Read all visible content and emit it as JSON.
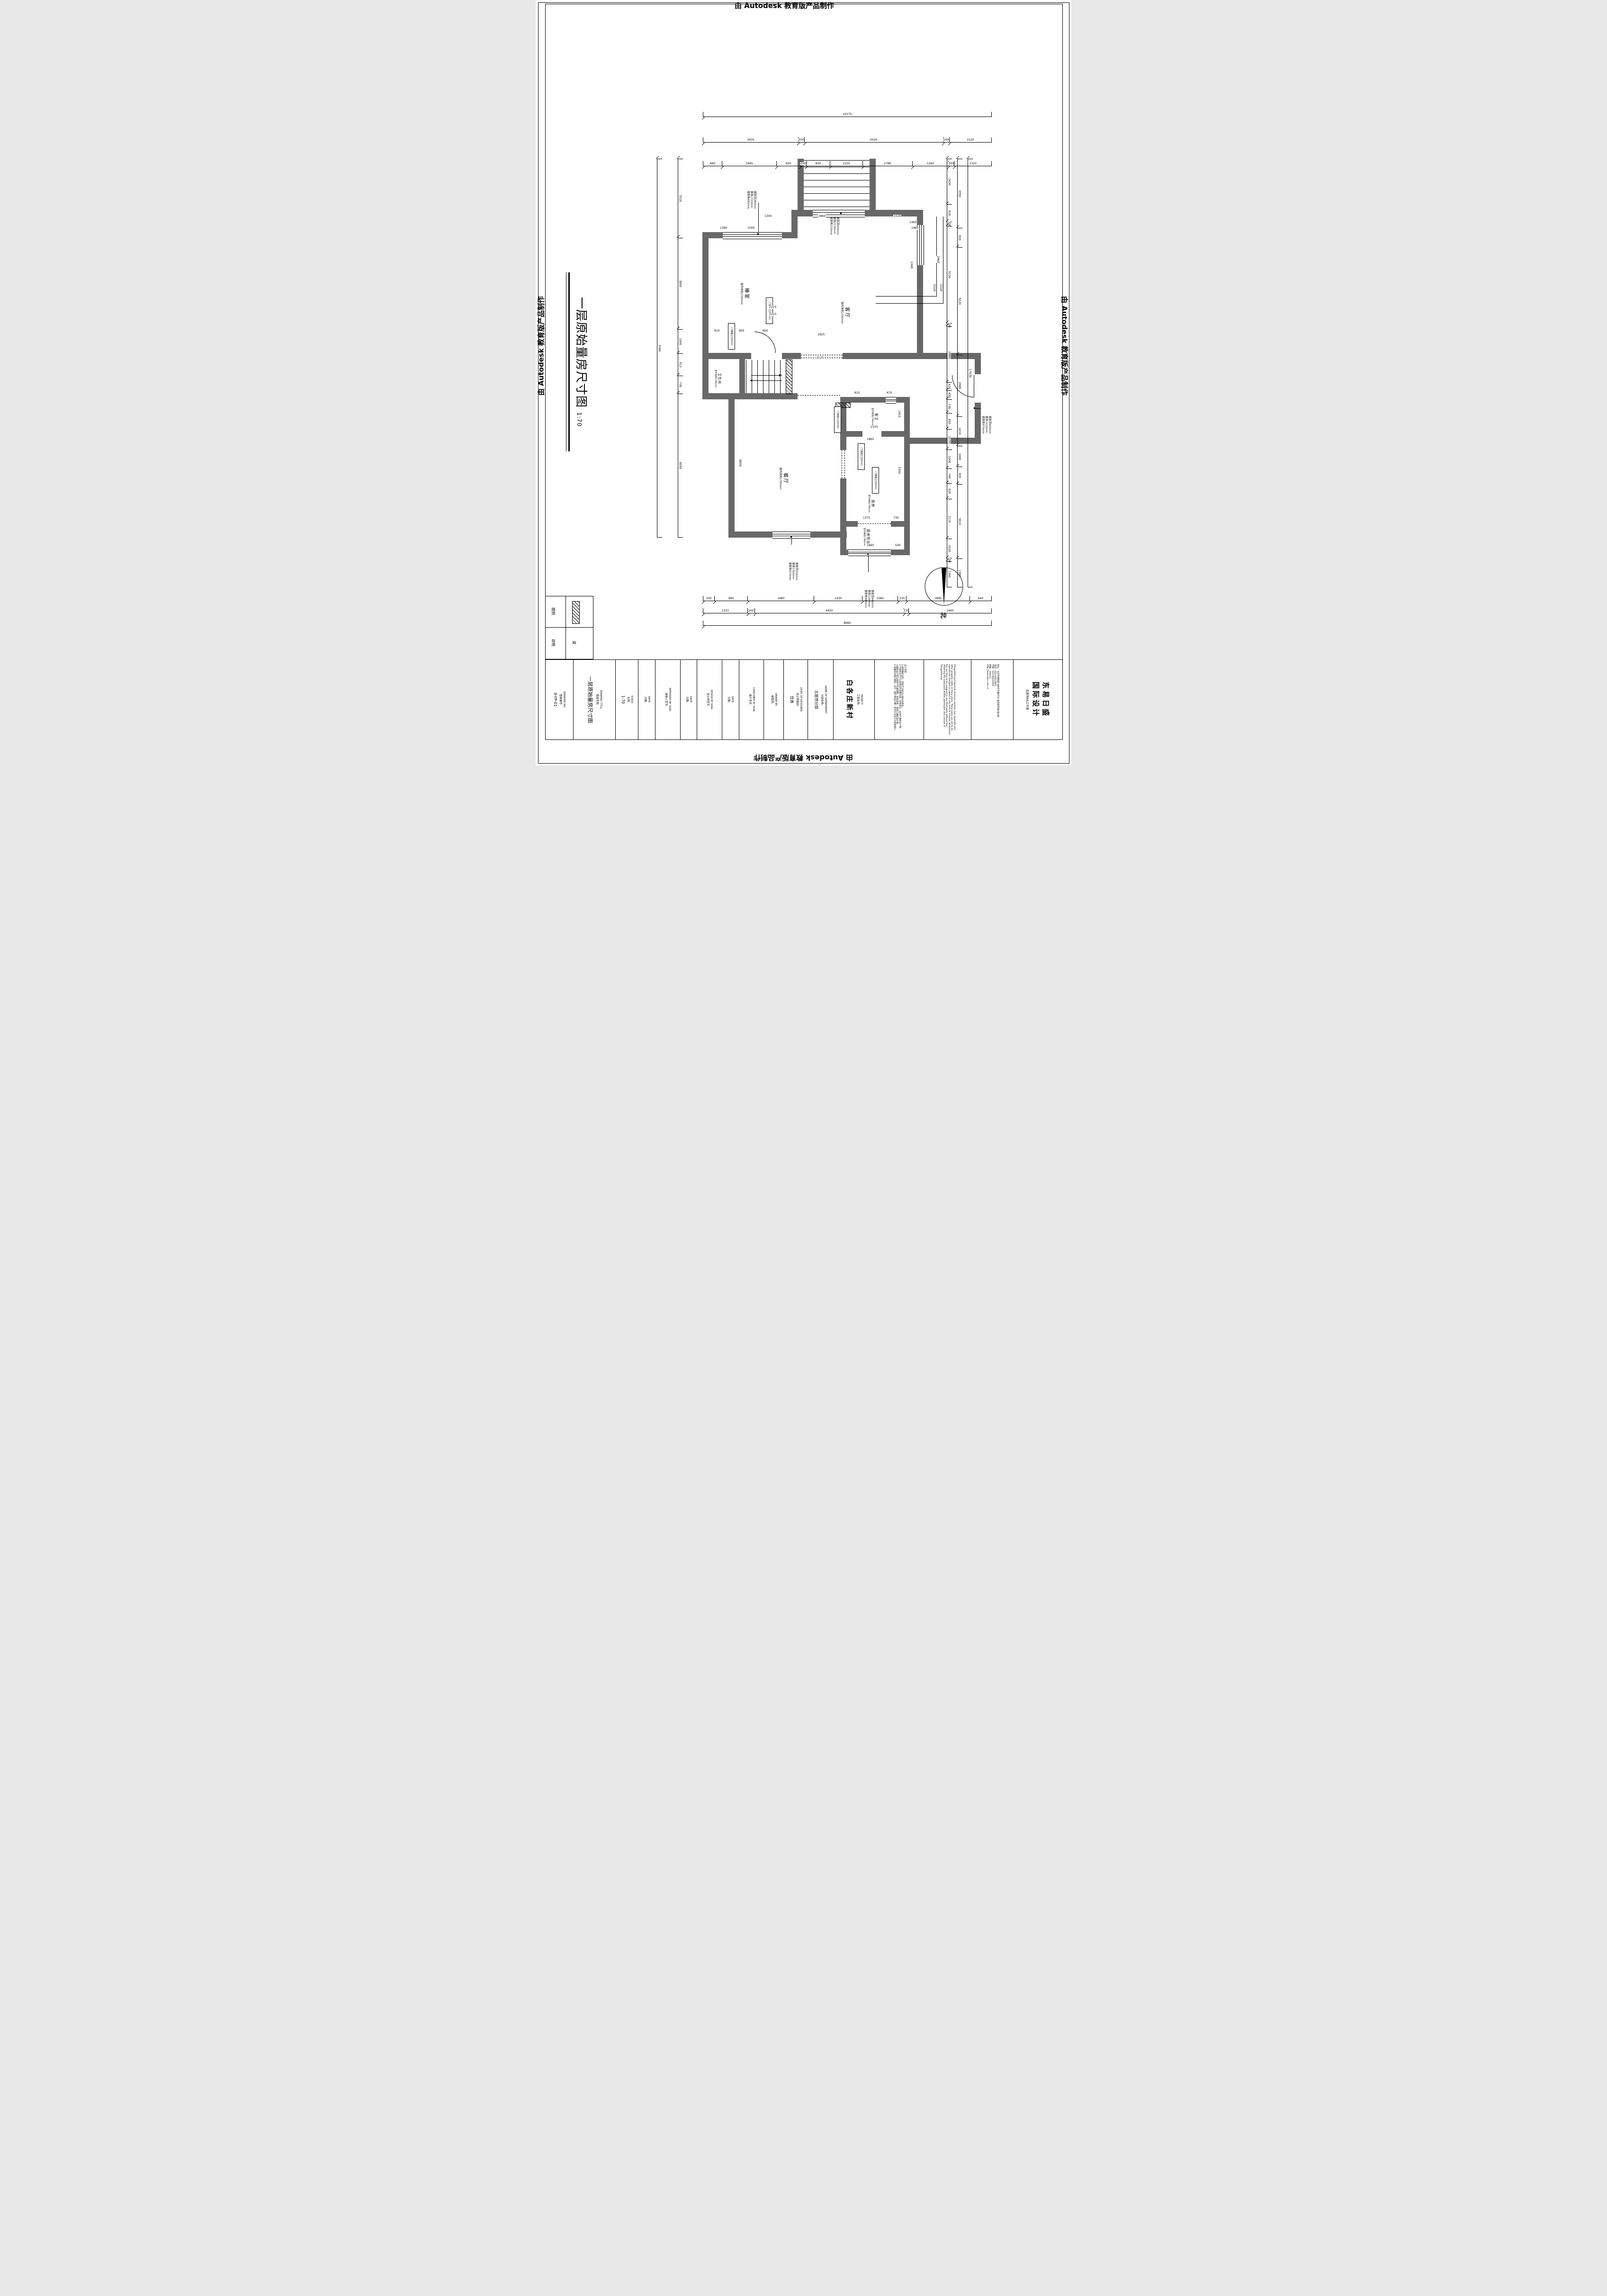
{
  "watermarks": {
    "top": "由 Autodesk 教育版产品制作",
    "right": "由 Autodesk 教育版产品制作",
    "bottom": "由 Autodesk 教育版产品制作",
    "left": "由 Autodesk 教育版产品制作"
  },
  "sheet": {
    "title": "一层原始量房尺寸图",
    "scale_note": "1:70"
  },
  "north": {
    "label": "北"
  },
  "rooms": {
    "bedroom": {
      "name": "睡室",
      "height": "室内净高2780mm"
    },
    "living": {
      "name": "客厅",
      "height": "室内净高2780mm"
    },
    "bath": {
      "name": "卫生间",
      "height": "室内净高2780mm"
    },
    "guest_bath": {
      "name": "客卫",
      "height": "室内净高2780mm"
    },
    "dining": {
      "name": "餐厅",
      "height": "室内净高2780mm"
    },
    "kitchen": {
      "name": "厨房",
      "height": "室内净高2780mm"
    },
    "balcony": {
      "name": "厨房阳台",
      "height": "室内净高2780mm"
    }
  },
  "door_note": "门洞高2150mm",
  "window_notes": {
    "bedroom": [
      "窗距顶380mm",
      "窗高1720mm",
      "窗距地680mm"
    ],
    "entry": [
      "窗距顶400mm",
      "窗高2230mm",
      "窗距地150mm"
    ],
    "vestibule": [
      "窗距顶400mm",
      "窗高1410mm",
      "窗距地970mm"
    ],
    "dining": [
      "窗距顶330mm",
      "窗高1760mm",
      "窗距地970mm"
    ],
    "balcony": [
      "窗距顶460mm",
      "窗高1340mm",
      "窗距地980mm"
    ]
  },
  "dims": {
    "top": {
      "total": [
        "10175"
      ],
      "mid": [
        "3435",
        "200",
        "5020",
        "200",
        "1520"
      ],
      "detail": [
        "660",
        "1945",
        "830",
        "200",
        "830",
        "1150",
        "1780",
        "1260",
        "200",
        "1320"
      ]
    },
    "left": {
      "total": [
        "7060"
      ],
      "detail": [
        "3320",
        "3850",
        "1000",
        "913",
        "730",
        "6050"
      ]
    },
    "right": {
      "total": [
        "17630"
      ],
      "mid": [
        "3350",
        "920",
        "5220",
        "2980",
        "1410",
        "1000",
        "820",
        "3610",
        "1360"
      ],
      "detail": [
        "2430",
        "920",
        "200",
        "5220",
        "150",
        "2980",
        "410",
        "450",
        "730",
        "850",
        "1070",
        "1000",
        "760",
        "820",
        "2110",
        "1020",
        "150",
        "1360"
      ]
    },
    "bottom": {
      "total": [
        "8660"
      ],
      "mid": [
        "1315",
        "200",
        "4450",
        "130",
        "2465"
      ],
      "detail": [
        "330",
        "985",
        "1980",
        "1430",
        "1060",
        "235",
        "1895",
        "640"
      ]
    },
    "plan": [
      "1300",
      "2860",
      "1530",
      "1380",
      "1000",
      "1460",
      "2210",
      "2210",
      "610",
      "900",
      "600",
      "1925",
      "2125",
      "5220",
      "5220",
      "2330",
      "1960",
      "810",
      "670",
      "1410",
      "3350",
      "8650",
      "1375",
      "730",
      "1895",
      "540",
      "2340",
      "2960",
      "1460"
    ]
  },
  "legend": {
    "header": "图例",
    "desc_header": "说明",
    "item_desc": "梁"
  },
  "title_block": {
    "drawing_no": {
      "en": "DRAWING NO:",
      "cn": "图纸编号:",
      "value": "A-YP-01"
    },
    "drawing_title": {
      "en": "DRAWING TITLE:",
      "cn": "图纸名称:",
      "value": "一层原始量房尺寸图"
    },
    "scale": {
      "en": "SCALE:",
      "cn": "比例:",
      "value": "1:70"
    },
    "date1": {
      "en": "DATE:",
      "cn": "日期:"
    },
    "approved": {
      "en": "APPROVED BY SIGN:",
      "cn": "审核人签字:"
    },
    "date2": {
      "en": "DATE:",
      "cn": "日期:"
    },
    "designer": {
      "en": "DESIGN BY SIGN:",
      "cn": "设计师签字:"
    },
    "date3": {
      "en": "DATE:",
      "cn": "日期:"
    },
    "consumer": {
      "en": "CONSUMER BY SIGN:",
      "cn": "客户签字:"
    },
    "drawn": {
      "en": "DRAWN BY:",
      "cn": "制图员:"
    },
    "level": {
      "en": "LEVEL OF DESIGNER:",
      "cn": "设计师级别:",
      "value": "优秀"
    },
    "department": {
      "en": "NAME OF DEPARTMENT:",
      "cn": "分部名称:",
      "value": "北居然分部"
    },
    "project": {
      "en": "PROJECT:",
      "cn": "工程名称:",
      "value": "白各庄新村"
    },
    "notes_title": "设计说明:",
    "notes": [
      "1.除特殊标注外，所有尺寸标注以毫米为单位。",
      "2.平面标注尺寸以现场实际测量为准，如有变化，会另行通知设计师。",
      "3.图纸设计若与现场不符请调整，如有变更，须另行通知设计师。",
      "4.该图纸为施工图纸，双方（客户和设计师）签字认可后方可指导施工。"
    ],
    "copyright": "Dongyirisheng Expressly reserves common law copyright and other property rights in these plans. These plans are not to be reproduced changed or copied in any form or manner whatsoever. Nor are they to be assigned to any third party without first obtaining the expressed written permission and consent of Dongyirisheng",
    "company": {
      "name1": "东易日盛",
      "name2": "国际设计",
      "studio": "北居然A6工作室",
      "address": "地址：北京市朝阳区北四环东路65号 居然装饰城2座4层",
      "tel": "电话：010-84633953",
      "fax": "传真：010-84633950",
      "zip": "邮编：100023",
      "web": "http://www.dyrs.com.cn"
    }
  }
}
